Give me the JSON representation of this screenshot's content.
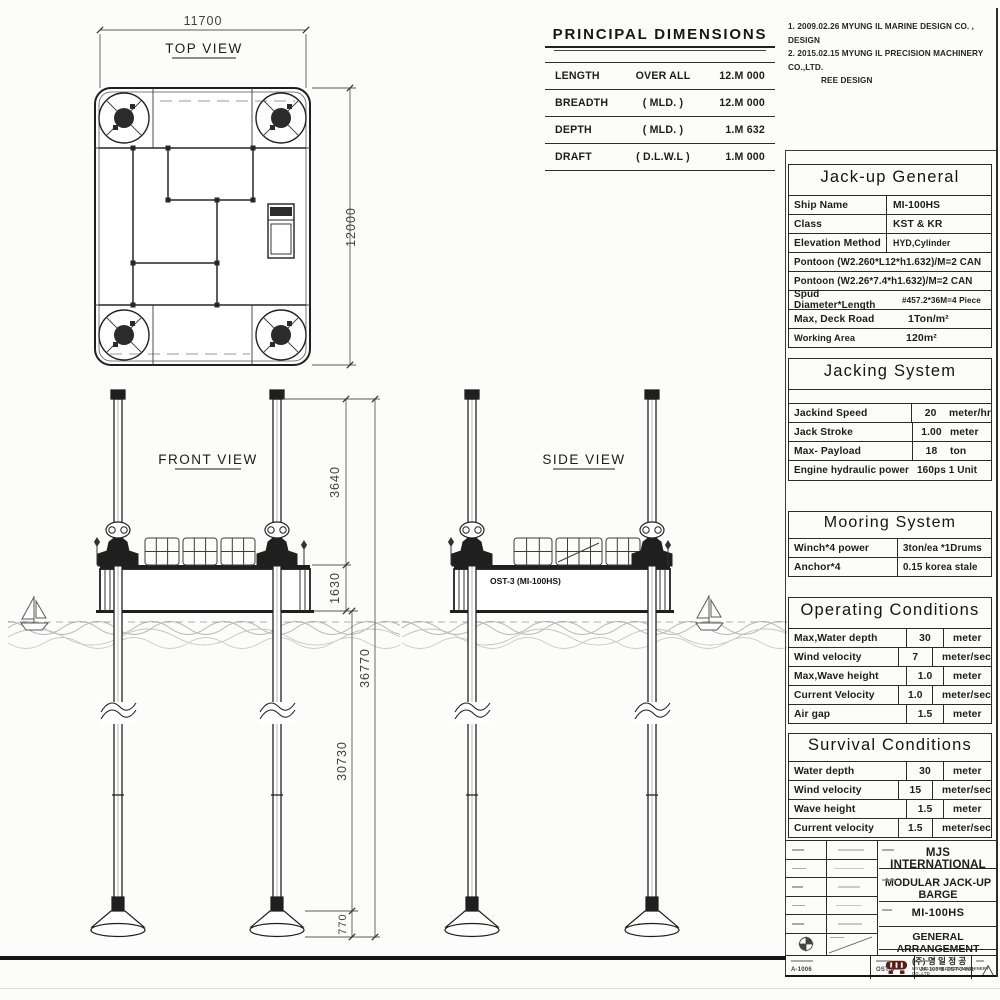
{
  "sheet": {
    "notes": [
      "1. 2009.02.26 MYUNG IL MARINE DESIGN CO. , DESIGN",
      "2. 2015.02.15 MYUNG IL PRECISION MACHINERY CO.,LTD.",
      "REE DESIGN"
    ]
  },
  "principal_dimensions": {
    "title": "PRINCIPAL DIMENSIONS",
    "rows": [
      {
        "name": "LENGTH",
        "qualifier": "OVER  ALL",
        "value": "12.M 000"
      },
      {
        "name": "BREADTH",
        "qualifier": "( MLD. )",
        "value": "12.M 000"
      },
      {
        "name": "DEPTH",
        "qualifier": "( MLD. )",
        "value": "1.M 632"
      },
      {
        "name": "DRAFT",
        "qualifier": "( D.L.W.L )",
        "value": "1.M 000"
      }
    ]
  },
  "views": {
    "top": {
      "label": "TOP VIEW",
      "dim_width": "11700",
      "dim_height": "12000"
    },
    "front": {
      "label": "FRONT VIEW",
      "dim_leg_top": "3640",
      "dim_hull_depth": "1630",
      "dim_overall": "36770",
      "dim_leg_bottom": "30730",
      "dim_foot": "770"
    },
    "side": {
      "label": "SIDE VIEW",
      "hull_label": "OST-3 (MI-100HS)"
    }
  },
  "tables": {
    "jack_up_general": {
      "title": "Jack-up General",
      "ship_name": {
        "label": "Ship Name",
        "value": "MI-100HS"
      },
      "class": {
        "label": "Class",
        "value": "KST & KR"
      },
      "elevation": {
        "label": "Elevation Method",
        "value": "HYD,Cylinder"
      },
      "pontoon1": "Pontoon (W2.260*L12*h1.632)/M=2 CAN",
      "pontoon2": "Pontoon (W2.26*7.4*h1.632)/M=2 CAN",
      "spud": {
        "label": "Spud Diameter*Length",
        "value": "#457.2*36M=4 Piece"
      },
      "deck_load": {
        "label": "Max, Deck Road",
        "value": "1Ton/m²"
      },
      "working_area": {
        "label": "Working Area",
        "value": "120m²"
      }
    },
    "jacking_system": {
      "title": "Jacking System",
      "rows": [
        {
          "label": "Jackind Speed",
          "value": "20",
          "unit": "meter/hr"
        },
        {
          "label": "Jack Stroke",
          "value": "1.00",
          "unit": "meter"
        },
        {
          "label": "Max- Payload",
          "value": "18",
          "unit": "ton"
        }
      ],
      "engine": {
        "label": "Engine hydraulic power",
        "value": "160ps 1 Unit"
      }
    },
    "mooring_system": {
      "title": "Mooring System",
      "rows": [
        {
          "label": "Winch*4  power",
          "value": "3ton/ea *1Drums"
        },
        {
          "label": "Anchor*4",
          "value": "0.15 korea stale"
        }
      ]
    },
    "operating_conditions": {
      "title": "Operating Conditions",
      "rows": [
        {
          "label": "Max,Water depth",
          "value": "30",
          "unit": "meter"
        },
        {
          "label": "Wind velocity",
          "value": "7",
          "unit": "meter/sec"
        },
        {
          "label": "Max,Wave height",
          "value": "1.0",
          "unit": "meter"
        },
        {
          "label": "Current Velocity",
          "value": "1.0",
          "unit": "meter/sec"
        },
        {
          "label": "Air gap",
          "value": "1.5",
          "unit": "meter"
        }
      ]
    },
    "survival_conditions": {
      "title": "Survival Conditions",
      "rows": [
        {
          "label": "Water depth",
          "value": "30",
          "unit": "meter"
        },
        {
          "label": "Wind velocity",
          "value": "15",
          "unit": "meter/sec"
        },
        {
          "label": "Wave height",
          "value": "1.5",
          "unit": "meter"
        },
        {
          "label": "Current velocity",
          "value": "1.5",
          "unit": "meter/sec"
        }
      ]
    }
  },
  "title_block": {
    "client": "MJS INTERNATIONAL",
    "project": "MODULAR JACK-UP BARGE",
    "ship_no": "MI-100HS",
    "drawing_title": "GENERAL ARRANGEMENT",
    "company_kr": "(주) 명 일 정 공",
    "company_en": "MYUNG IL PRECISION MACHINERY CO.,LTD",
    "file_no": "A-1006",
    "job_no": "OST-3",
    "dwg_no": "JA-100-B-OST-3-001"
  },
  "colors": {
    "ink": "#1d1d1d",
    "dim_text": "#3f3f3f",
    "wave": "#adadad",
    "logo": "#5d1d15"
  }
}
